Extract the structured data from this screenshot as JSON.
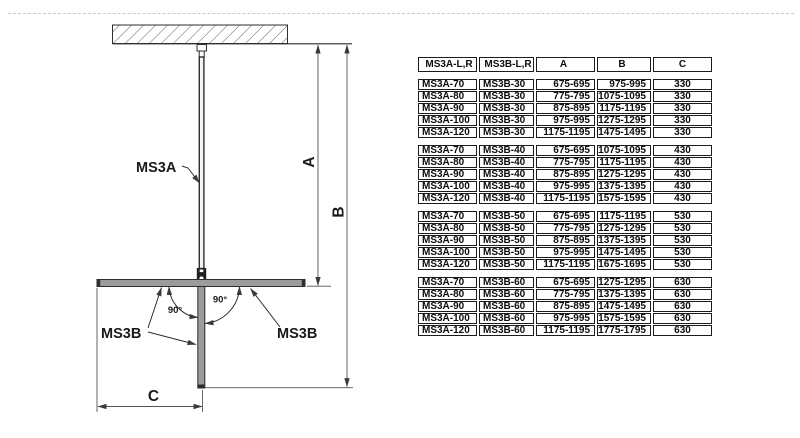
{
  "diagram": {
    "panel_label_main": "MS3A",
    "panel_label_left": "MS3B",
    "panel_label_right": "MS3B",
    "dim_a_label": "A",
    "dim_b_label": "B",
    "dim_c_label": "C",
    "angle_left_label": "90°",
    "angle_right_label": "90°",
    "colors": {
      "line": "#2e2e2e",
      "dim_line": "#555555",
      "panel_fill": "#9c9c9c",
      "connector_fill": "#202020"
    }
  },
  "table": {
    "headers": [
      "MS3A-L,R",
      "MS3B-L,R",
      "A",
      "B",
      "C"
    ],
    "groups": [
      {
        "rows": [
          [
            "MS3A-70",
            "MS3B-30",
            "675-695",
            "975-995",
            "330"
          ],
          [
            "MS3A-80",
            "MS3B-30",
            "775-795",
            "1075-1095",
            "330"
          ],
          [
            "MS3A-90",
            "MS3B-30",
            "875-895",
            "1175-1195",
            "330"
          ],
          [
            "MS3A-100",
            "MS3B-30",
            "975-995",
            "1275-1295",
            "330"
          ],
          [
            "MS3A-120",
            "MS3B-30",
            "1175-1195",
            "1475-1495",
            "330"
          ]
        ]
      },
      {
        "rows": [
          [
            "MS3A-70",
            "MS3B-40",
            "675-695",
            "1075-1095",
            "430"
          ],
          [
            "MS3A-80",
            "MS3B-40",
            "775-795",
            "1175-1195",
            "430"
          ],
          [
            "MS3A-90",
            "MS3B-40",
            "875-895",
            "1275-1295",
            "430"
          ],
          [
            "MS3A-100",
            "MS3B-40",
            "975-995",
            "1375-1395",
            "430"
          ],
          [
            "MS3A-120",
            "MS3B-40",
            "1175-1195",
            "1575-1595",
            "430"
          ]
        ]
      },
      {
        "rows": [
          [
            "MS3A-70",
            "MS3B-50",
            "675-695",
            "1175-1195",
            "530"
          ],
          [
            "MS3A-80",
            "MS3B-50",
            "775-795",
            "1275-1295",
            "530"
          ],
          [
            "MS3A-90",
            "MS3B-50",
            "875-895",
            "1375-1395",
            "530"
          ],
          [
            "MS3A-100",
            "MS3B-50",
            "975-995",
            "1475-1495",
            "530"
          ],
          [
            "MS3A-120",
            "MS3B-50",
            "1175-1195",
            "1675-1695",
            "530"
          ]
        ]
      },
      {
        "rows": [
          [
            "MS3A-70",
            "MS3B-60",
            "675-695",
            "1275-1295",
            "630"
          ],
          [
            "MS3A-80",
            "MS3B-60",
            "775-795",
            "1375-1395",
            "630"
          ],
          [
            "MS3A-90",
            "MS3B-60",
            "875-895",
            "1475-1495",
            "630"
          ],
          [
            "MS3A-100",
            "MS3B-60",
            "975-995",
            "1575-1595",
            "630"
          ],
          [
            "MS3A-120",
            "MS3B-60",
            "1175-1195",
            "1775-1795",
            "630"
          ]
        ]
      }
    ]
  }
}
